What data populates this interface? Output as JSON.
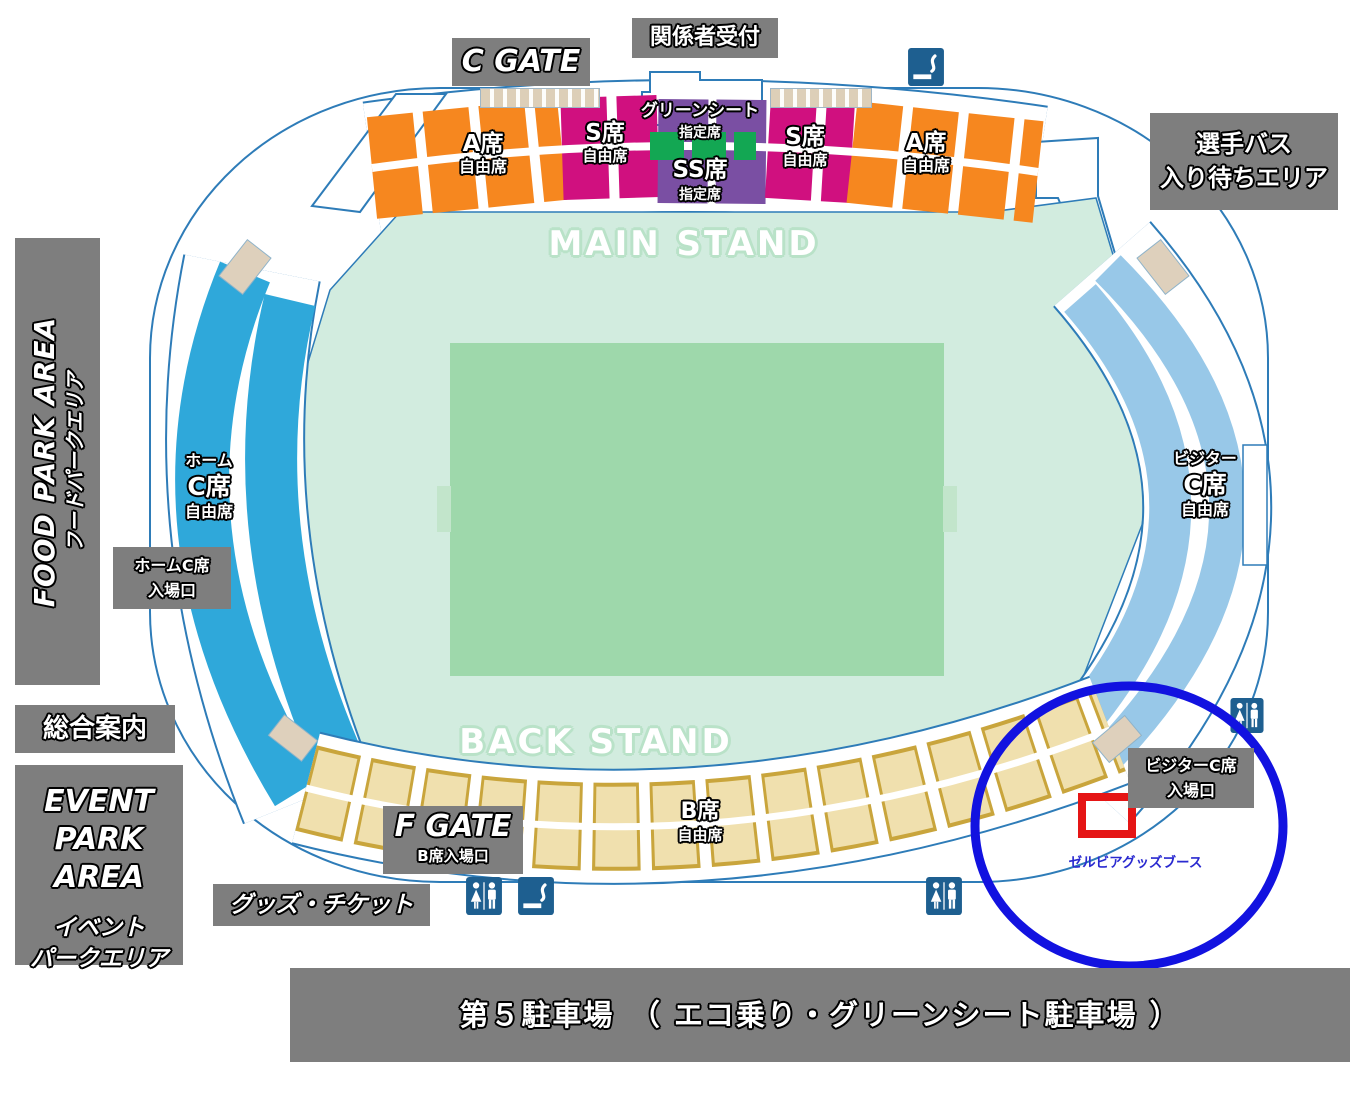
{
  "stands": {
    "main": "MAIN STAND",
    "back": "BACK STAND"
  },
  "gates": {
    "c_gate": "C GATE",
    "f_gate": "F GATE",
    "f_gate_sub": "B席入場口"
  },
  "areas": {
    "reception": "関係者受付",
    "player_bus_line1": "選手バス",
    "player_bus_line2": "入り待ちエリア",
    "food_park_en": "FOOD PARK AREA",
    "food_park_ja": "フードパークエリア",
    "info": "総合案内",
    "event_park_en1": "EVENT",
    "event_park_en2": "PARK AREA",
    "event_park_ja1": "イベント",
    "event_park_ja2": "パークエリア",
    "goods_ticket": "グッズ・チケット",
    "parking": "第５駐車場　（ エコ乗り・グリーンシート駐車場 ）",
    "zelvia_booth": "ゼルビアグッズブース",
    "home_c_entrance_line1": "ホームC席",
    "home_c_entrance_line2": "入場口",
    "visitor_c_entrance_line1": "ビジターC席",
    "visitor_c_entrance_line2": "入場口"
  },
  "sections": {
    "a_left_name": "A席",
    "a_left_type": "自由席",
    "s_left_name": "S席",
    "s_left_type": "自由席",
    "green_name": "グリーンシート",
    "green_type": "指定席",
    "ss_name": "SS席",
    "ss_type": "指定席",
    "s_right_name": "S席",
    "s_right_type": "自由席",
    "a_right_name": "A席",
    "a_right_type": "自由席",
    "home_prefix": "ホーム",
    "home_name": "C席",
    "home_type": "自由席",
    "visitor_prefix": "ビジター",
    "visitor_name": "C席",
    "visitor_type": "自由席",
    "b_name": "B席",
    "b_type": "自由席"
  },
  "icons": {
    "top": "smoking-area-icon",
    "bottom_left_1": "toilet-icon",
    "bottom_left_2": "smoking-area-icon",
    "bottom_center": "toilet-icon",
    "right": "toilet-icon"
  },
  "colors": {
    "outline_blue": "#2e7cb8",
    "concourse_mint": "#d2ecdf",
    "field_green": "#9ed8ab",
    "home_stand_cyan": "#2fa8da",
    "visitor_stand_blue": "#98c8e8",
    "seat_a_orange": "#f6871f",
    "seat_s_magenta": "#d0107f",
    "seat_ss_purple": "#7a4fa3",
    "seat_green_sheet": "#13a753",
    "seat_b_tan": "#f0e0ae",
    "seat_b_border": "#c9a53c",
    "label_gray": "#7e7e7e",
    "icon_blue": "#1e5f90",
    "highlight_circle_blue": "#1212e0",
    "highlight_box_red": "#e51515"
  }
}
